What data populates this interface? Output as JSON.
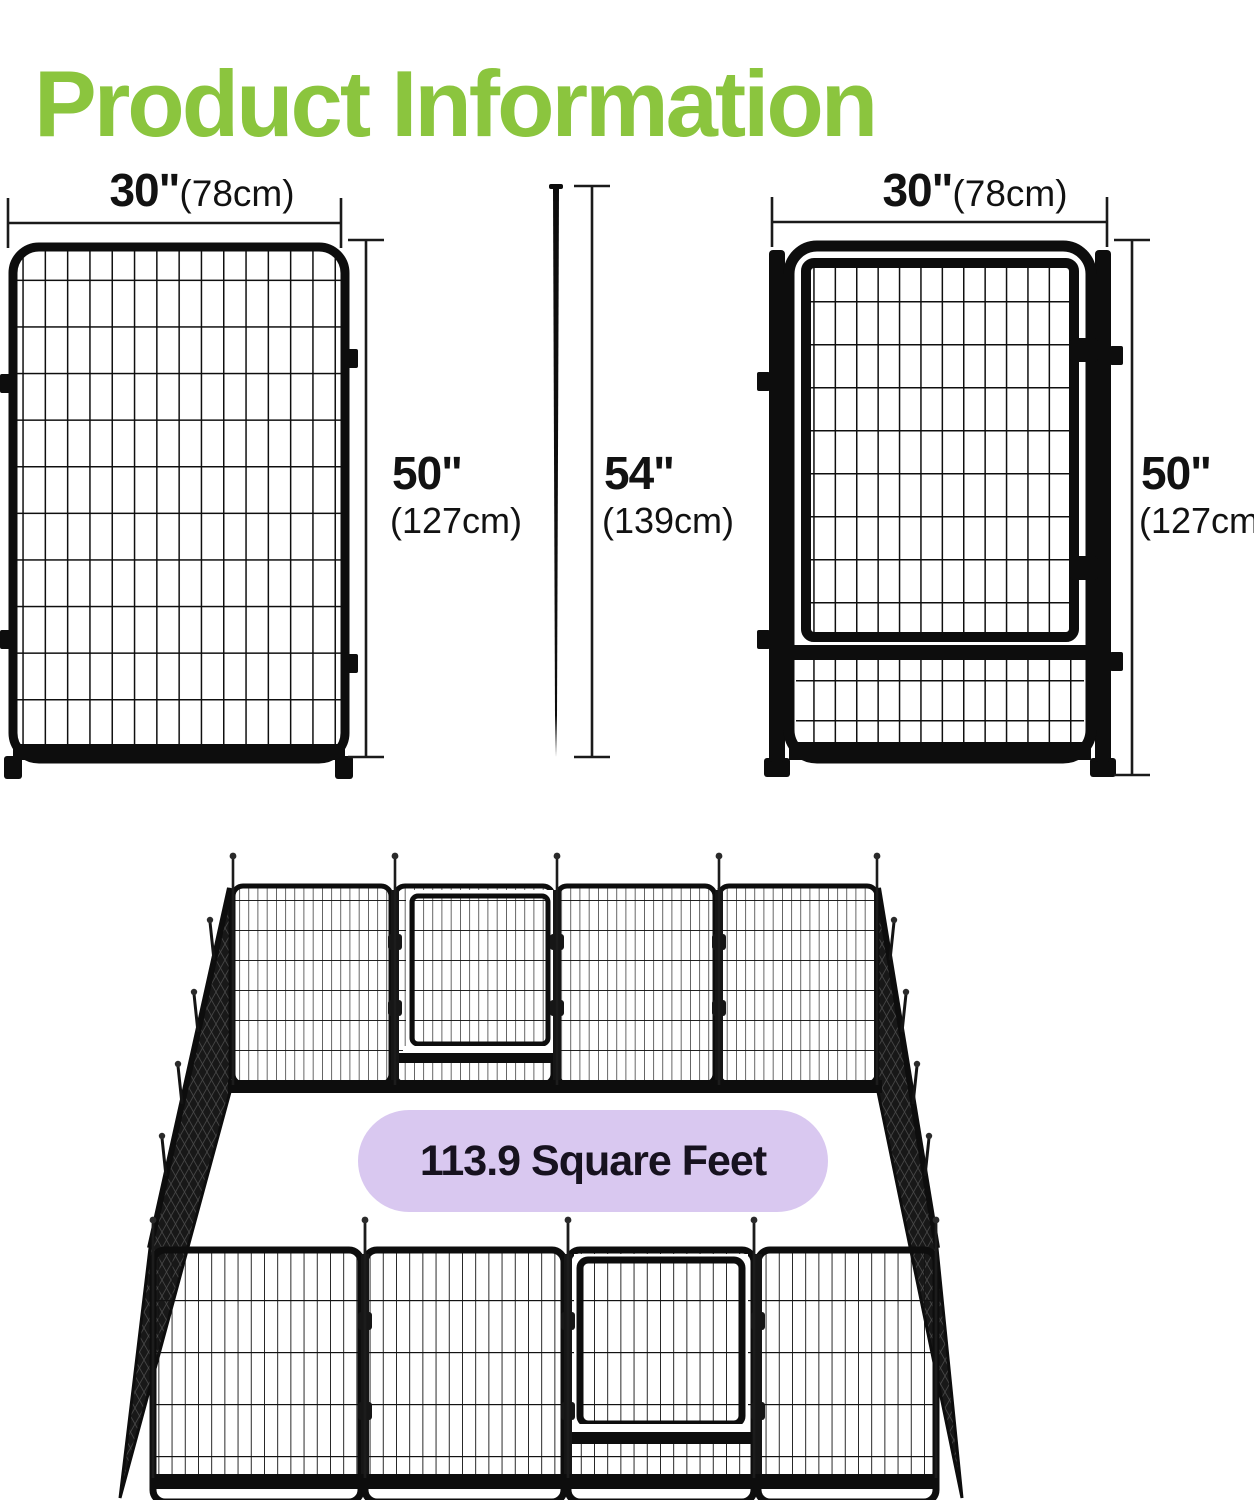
{
  "page": {
    "title": "Product Information"
  },
  "colors": {
    "accent_green": "#8BC53E",
    "fence_black": "#0D0D0D",
    "pill_lavender": "#D9C8F0",
    "pill_text": "#17121F",
    "dim_line": "#1A1A1A"
  },
  "diagrams": {
    "left_panel": {
      "kind": "fence panel front view",
      "width_in": "30\"",
      "width_cm": "(78cm)",
      "height_in": "50\"",
      "height_cm": "(127cm)"
    },
    "stake": {
      "kind": "ground stake side view",
      "height_in": "54\"",
      "height_cm": "(139cm)"
    },
    "gate_panel": {
      "kind": "gate panel front view",
      "width_in": "30\"",
      "width_cm": "(78cm)",
      "height_in": "50\"",
      "height_cm": "(127cm)"
    }
  },
  "assembled_view": {
    "kind": "16-panel playpen isometric view",
    "area_label": "113.9 Square Feet"
  }
}
